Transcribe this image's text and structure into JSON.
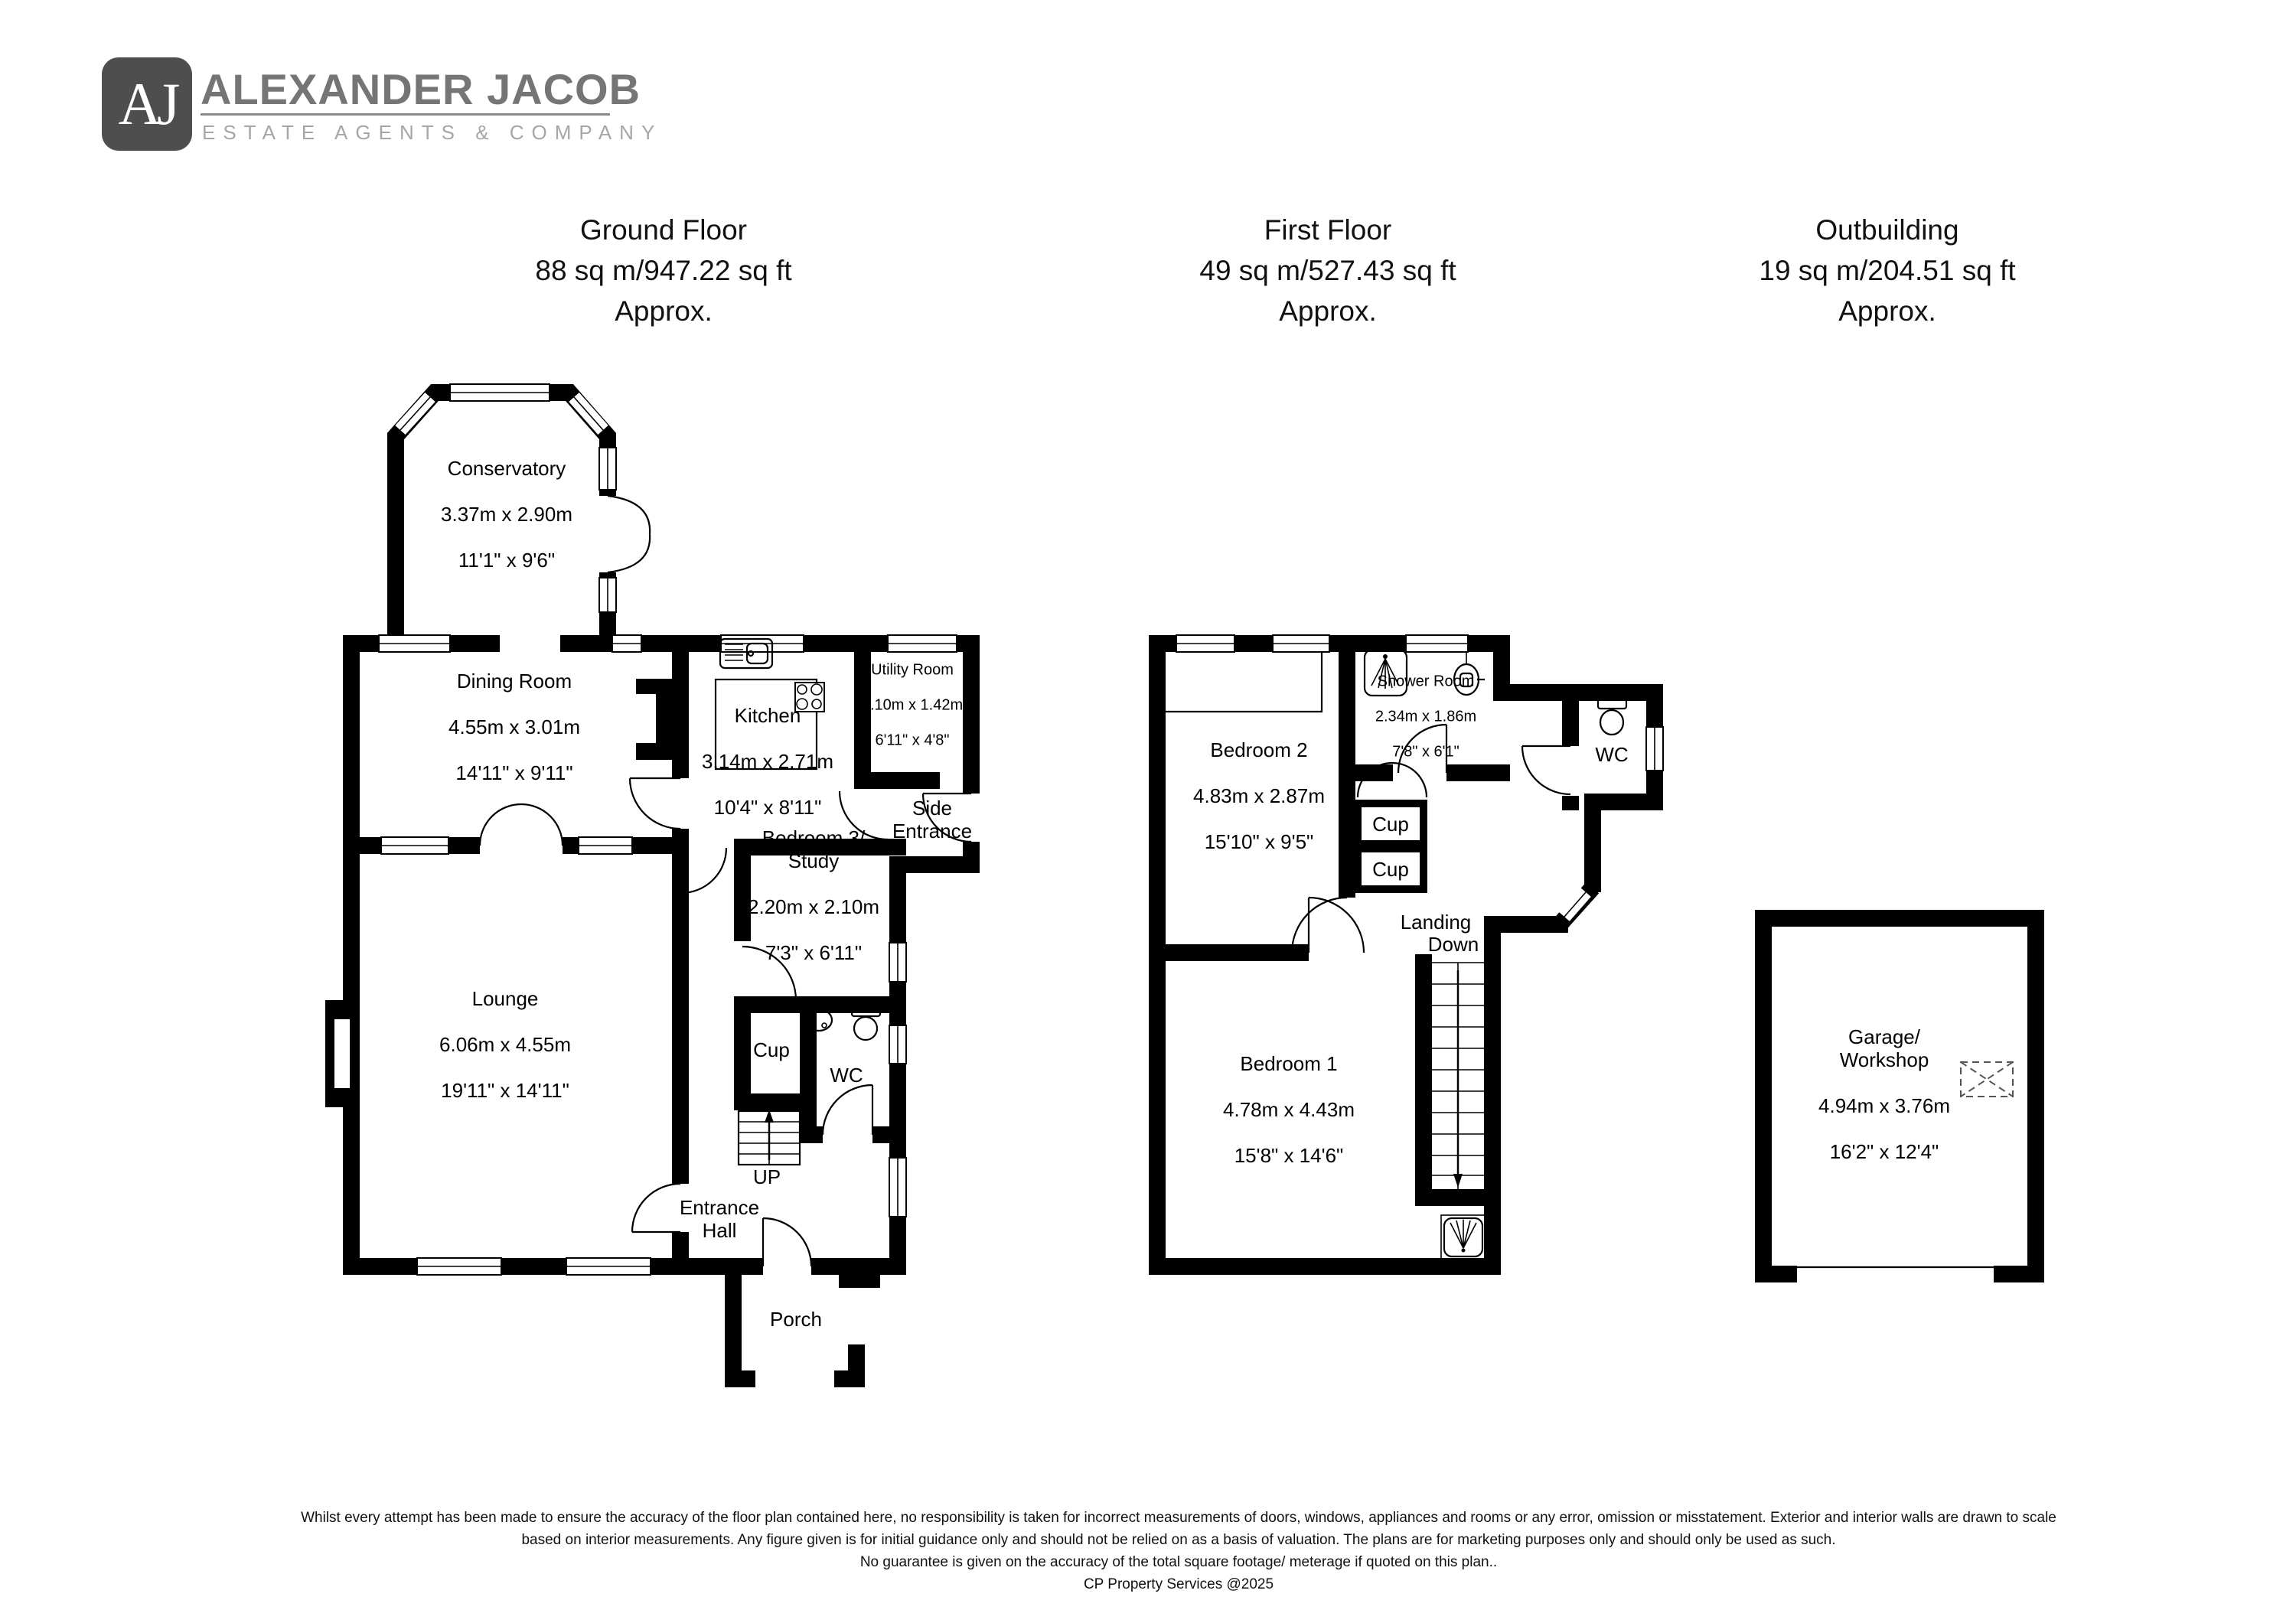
{
  "logo": {
    "initials": "AJ",
    "name": "ALEXANDER JACOB",
    "tagline": "ESTATE AGENTS & COMPANY"
  },
  "colors": {
    "wall": "#000000",
    "logo_box": "#4e4e4e",
    "logo_text": "#757575",
    "logo_tagline": "#a6a6a6"
  },
  "floors": {
    "ground": {
      "title": "Ground Floor",
      "area": "88 sq m/947.22 sq ft",
      "approx": "Approx."
    },
    "first": {
      "title": "First Floor",
      "area": "49 sq m/527.43 sq ft",
      "approx": "Approx."
    },
    "outbuilding": {
      "title": "Outbuilding",
      "area": "19 sq m/204.51 sq ft",
      "approx": "Approx."
    }
  },
  "rooms": {
    "conservatory": {
      "name": "Conservatory",
      "metric": "3.37m x 2.90m",
      "imperial": "11'1\" x 9'6\""
    },
    "dining": {
      "name": "Dining Room",
      "metric": "4.55m x 3.01m",
      "imperial": "14'11\" x 9'11\""
    },
    "kitchen": {
      "name": "Kitchen",
      "metric": "3.14m x 2.71m",
      "imperial": "10'4\" x 8'11\""
    },
    "utility": {
      "name": "Utility Room",
      "metric": "2.10m x 1.42m",
      "imperial": "6'11\" x 4'8\""
    },
    "side_entrance": {
      "name": "Side\nEntrance"
    },
    "bedroom3": {
      "name": "Bedroom 3/\nStudy",
      "metric": "2.20m x 2.10m",
      "imperial": "7'3\" x 6'11\""
    },
    "lounge": {
      "name": "Lounge",
      "metric": "6.06m x 4.55m",
      "imperial": "19'11\" x 14'11\""
    },
    "cup_ground": {
      "name": "Cup"
    },
    "wc_ground": {
      "name": "WC"
    },
    "up": {
      "name": "UP"
    },
    "entrance_hall": {
      "name": "Entrance\nHall"
    },
    "porch": {
      "name": "Porch"
    },
    "bedroom2": {
      "name": "Bedroom 2",
      "metric": "4.83m x 2.87m",
      "imperial": "15'10\" x 9'5\""
    },
    "shower_room": {
      "name": "Shower Room",
      "metric": "2.34m x 1.86m",
      "imperial": "7'8\" x 6'1\""
    },
    "wc_first": {
      "name": "WC"
    },
    "cup1": {
      "name": "Cup"
    },
    "cup2": {
      "name": "Cup"
    },
    "landing": {
      "name": "Landing"
    },
    "down": {
      "name": "Down"
    },
    "bedroom1": {
      "name": "Bedroom 1",
      "metric": "4.78m x 4.43m",
      "imperial": "15'8\" x 14'6\""
    },
    "garage": {
      "name": "Garage/\nWorkshop",
      "metric": "4.94m x 3.76m",
      "imperial": "16'2\" x 12'4\""
    }
  },
  "disclaimer": {
    "line1": "Whilst every attempt has been made to ensure the accuracy of the floor plan contained here, no responsibility is taken for incorrect measurements of doors, windows, appliances and rooms or any error, omission or misstatement. Exterior and interior walls are drawn to scale",
    "line2": "based on interior measurements. Any figure given is for initial guidance only and should not be relied on as a basis of valuation. The plans are for marketing purposes only and should only be used as such.",
    "line3": "No guarantee is given on the accuracy of the total square footage/ meterage if quoted on this plan..",
    "line4": "CP Property Services @2025"
  }
}
